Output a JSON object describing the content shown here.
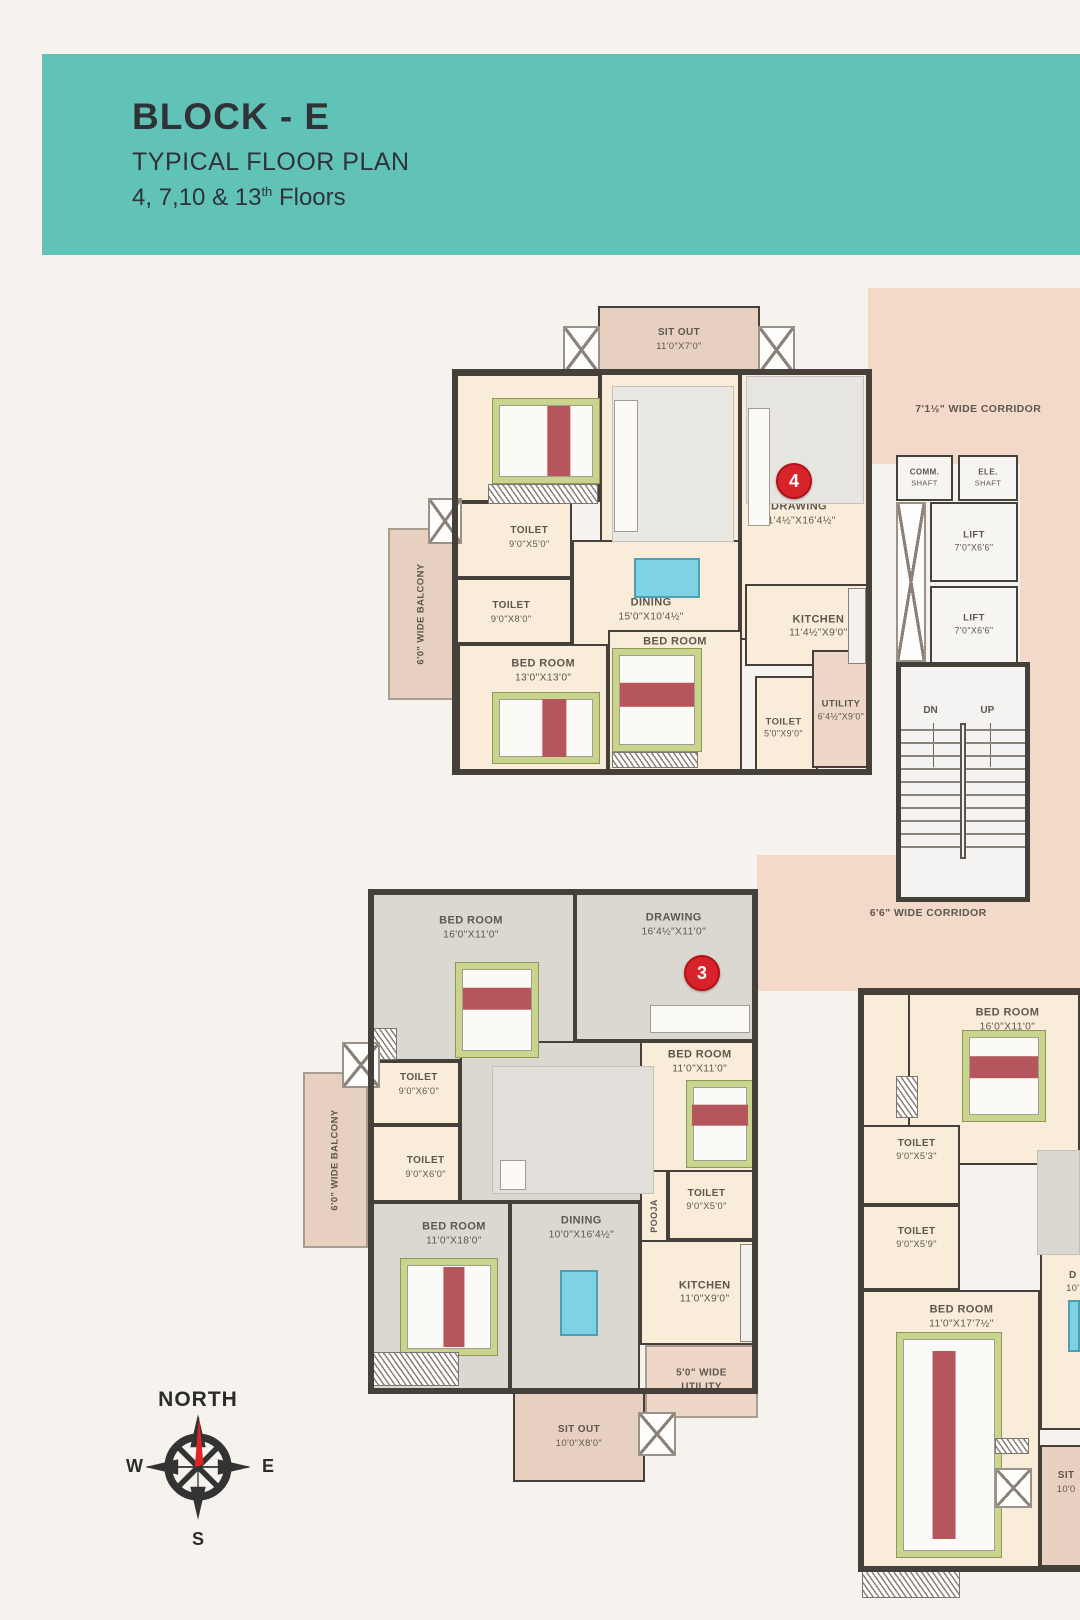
{
  "header": {
    "title": "BLOCK - E",
    "subtitle": "TYPICAL FLOOR PLAN",
    "floors": "4, 7,10 & 13",
    "floors_sup": "th",
    "floors_tail": " Floors",
    "band_color": "#61c2b8",
    "text_color": "#2f3338"
  },
  "compass": {
    "north": "NORTH",
    "west": "W",
    "east": "E",
    "south": "S"
  },
  "plan": {
    "wall_color": "#46403a",
    "room_fill": "#f9ecd9",
    "gray_fill": "#dbd7d1",
    "tan_fill": "#e8d0c0",
    "pink_fill": "#f3d9c8",
    "utility_fill": "#eed7c7",
    "white_fill": "#f6f5f2",
    "marker_color": "#d8232a",
    "stairs": {
      "dn": "DN",
      "up": "UP"
    },
    "markers": [
      {
        "num": "4",
        "x": 792,
        "y": 479
      },
      {
        "num": "3",
        "x": 700,
        "y": 971
      }
    ],
    "units": [
      {
        "name": "unit-4-outline",
        "x": 452,
        "y": 369,
        "w": 420,
        "h": 406
      },
      {
        "name": "unit-3-outline",
        "x": 368,
        "y": 889,
        "w": 390,
        "h": 505
      },
      {
        "name": "unit-right-outline",
        "x": 858,
        "y": 988,
        "w": 232,
        "h": 584
      }
    ],
    "zones": [
      {
        "name": "corridor-top",
        "label": "7'1½\" WIDE CORRIDOR",
        "x": 868,
        "y": 288,
        "w": 212,
        "h": 176,
        "fill": "#f3d9c8",
        "lx": 52,
        "ly": 69,
        "fs": 10.5
      },
      {
        "name": "corridor-right",
        "x": 1020,
        "y": 462,
        "w": 60,
        "h": 396,
        "fill": "#f3d9c8"
      },
      {
        "name": "corridor-mid",
        "label": "6'6\" WIDE CORRIDOR",
        "x": 757,
        "y": 855,
        "w": 323,
        "h": 136,
        "fill": "#f3d9c8",
        "lx": 53,
        "ly": 43,
        "fs": 10.5
      },
      {
        "name": "balcony-unit4",
        "label": "6'0\" WIDE BALCONY",
        "x": 388,
        "y": 528,
        "w": 67,
        "h": 172,
        "fill": "#e8d0c0",
        "vertical": true,
        "bordered": true,
        "fs": 9.5
      },
      {
        "name": "balcony-unit3",
        "label": "6'0\" WIDE BALCONY",
        "x": 303,
        "y": 1072,
        "w": 65,
        "h": 176,
        "fill": "#e8d0c0",
        "vertical": true,
        "bordered": true,
        "fs": 9.5
      },
      {
        "name": "utility-unit3",
        "label": "5'0\" WIDE UTILITY",
        "x": 645,
        "y": 1345,
        "w": 113,
        "h": 73,
        "fill": "#eed7c7",
        "bordered": true,
        "wrap": true,
        "lx": 50,
        "ly": 48,
        "fs": 10
      }
    ],
    "rooms": [
      {
        "name": "sitout-unit4",
        "line1": "SIT OUT",
        "line2": "11'0\"X7'0\"",
        "x": 598,
        "y": 306,
        "w": 162,
        "h": 66,
        "fill": "#e8d0c0",
        "fs": 10
      },
      {
        "name": "bedroom-1-unit4",
        "line1": "BED ROOM",
        "line2": "13'0\"X11'0\"",
        "x": 455,
        "y": 374,
        "w": 145,
        "h": 128,
        "lx": 60,
        "ly": 42
      },
      {
        "name": "living-unit4",
        "line1": "LIVING",
        "line2": "11'0\"X10'4½\"",
        "x": 600,
        "y": 372,
        "w": 140,
        "h": 180,
        "lx": 70,
        "ly": 42
      },
      {
        "name": "drawing-unit4",
        "line1": "DRAWING",
        "line2": "11'4½\"X16'4½\"",
        "x": 740,
        "y": 372,
        "w": 128,
        "h": 268,
        "lx": 46,
        "ly": 53
      },
      {
        "name": "toilet-1-unit4",
        "line1": "TOILET",
        "line2": "9'0\"X5'0\"",
        "x": 455,
        "y": 502,
        "w": 117,
        "h": 76,
        "lx": 64,
        "ly": 46,
        "fs": 10
      },
      {
        "name": "toilet-2-unit4",
        "line1": "TOILET",
        "line2": "9'0\"X8'0\"",
        "x": 455,
        "y": 578,
        "w": 117,
        "h": 66,
        "lx": 48,
        "ly": 52,
        "fs": 10
      },
      {
        "name": "dining-unit4",
        "line1": "DINING",
        "line2": "15'0\"X10'4½\"",
        "x": 572,
        "y": 540,
        "w": 168,
        "h": 110,
        "lx": 47,
        "ly": 64
      },
      {
        "name": "kitchen-unit4",
        "line1": "KITCHEN",
        "line2": "11'4½\"X9'0\"",
        "x": 745,
        "y": 584,
        "w": 123,
        "h": 82,
        "lx": 60,
        "ly": 52
      },
      {
        "name": "bedroom-2-unit4",
        "line1": "BED ROOM",
        "line2": "13'0\"X13'0\"",
        "x": 458,
        "y": 644,
        "w": 150,
        "h": 128,
        "lx": 57,
        "ly": 20
      },
      {
        "name": "bedroom-3-unit4",
        "line1": "BED ROOM",
        "line2": "11'0\"X13'0\"",
        "x": 608,
        "y": 630,
        "w": 134,
        "h": 142,
        "lx": 50,
        "ly": 12
      },
      {
        "name": "toilet-3-unit4",
        "line1": "TOILET",
        "line2": "5'0\"X9'0\"",
        "x": 755,
        "y": 676,
        "w": 63,
        "h": 96,
        "lx": 45,
        "ly": 55,
        "fs": 9.5
      },
      {
        "name": "utility-unit4",
        "line1": "UTILITY",
        "line2": "6'4½\"X9'0\"",
        "x": 812,
        "y": 650,
        "w": 58,
        "h": 118,
        "fill": "#eed7c7",
        "lx": 50,
        "ly": 52,
        "fs": 9.5
      },
      {
        "name": "comm-shaft",
        "line1": "COMM.",
        "line2": "SHAFT",
        "x": 896,
        "y": 455,
        "w": 57,
        "h": 46,
        "fill": "#f6f5f2",
        "fs": 8
      },
      {
        "name": "ele-shaft",
        "line1": "ELE.",
        "line2": "SHAFT",
        "x": 958,
        "y": 455,
        "w": 60,
        "h": 46,
        "fill": "#f6f5f2",
        "fs": 8
      },
      {
        "name": "lift-1",
        "line1": "LIFT",
        "line2": "7'0\"X6'6\"",
        "x": 930,
        "y": 502,
        "w": 88,
        "h": 80,
        "fill": "#f6f5f2",
        "fs": 9.5
      },
      {
        "name": "lift-2",
        "line1": "LIFT",
        "line2": "7'0\"X6'6\"",
        "x": 930,
        "y": 586,
        "w": 88,
        "h": 78,
        "fill": "#f6f5f2",
        "fs": 9.5
      },
      {
        "name": "bedroom-1-unit3",
        "line1": "BED ROOM",
        "line2": "16'0\"X11'0\"",
        "x": 371,
        "y": 893,
        "w": 204,
        "h": 168,
        "fill": "#dbd7d1",
        "lx": 49,
        "ly": 20
      },
      {
        "name": "drawing-unit3",
        "line1": "DRAWING",
        "line2": "16'4½\"X11'0\"",
        "x": 575,
        "y": 893,
        "w": 180,
        "h": 148,
        "fill": "#dbd7d1",
        "lx": 55,
        "ly": 21
      },
      {
        "name": "toilet-1-unit3",
        "line1": "TOILET",
        "line2": "9'0\"X6'0\"",
        "x": 371,
        "y": 1061,
        "w": 89,
        "h": 64,
        "lx": 54,
        "ly": 35,
        "fs": 10
      },
      {
        "name": "toilet-2-unit3",
        "line1": "TOILET",
        "line2": "9'0\"X6'0\"",
        "x": 371,
        "y": 1125,
        "w": 89,
        "h": 77,
        "lx": 62,
        "ly": 55,
        "fs": 10
      },
      {
        "name": "living-unit3",
        "line1": "LIVING",
        "line2": "12'0\"X12'0\"",
        "x": 460,
        "y": 1041,
        "w": 200,
        "h": 161,
        "fill": "#dbd7d1",
        "lx": 73,
        "ly": 55
      },
      {
        "name": "bedroom-2-unit3",
        "line1": "BED ROOM",
        "line2": "11'0\"X11'0\"",
        "x": 640,
        "y": 1041,
        "w": 115,
        "h": 131,
        "lx": 52,
        "ly": 15
      },
      {
        "name": "toilet-3-unit3",
        "line1": "TOILET",
        "line2": "9'0\"X5'0\"",
        "x": 668,
        "y": 1170,
        "w": 87,
        "h": 70,
        "lx": 44,
        "ly": 42,
        "fs": 10
      },
      {
        "name": "pooja-unit3",
        "line1": "POOJA",
        "x": 640,
        "y": 1170,
        "w": 28,
        "h": 92,
        "vertical": true,
        "fs": 9
      },
      {
        "name": "dining-unit3",
        "line1": "DINING",
        "line2": "10'0\"X16'4½\"",
        "x": 510,
        "y": 1202,
        "w": 130,
        "h": 190,
        "fill": "#dbd7d1",
        "lx": 55,
        "ly": 13
      },
      {
        "name": "bedroom-3-unit3",
        "line1": "BED ROOM",
        "line2": "11'0\"X18'0\"",
        "x": 371,
        "y": 1202,
        "w": 139,
        "h": 190,
        "fill": "#dbd7d1",
        "lx": 60,
        "ly": 16
      },
      {
        "name": "kitchen-unit3",
        "line1": "KITCHEN",
        "line2": "11'0\"X9'0\"",
        "x": 640,
        "y": 1240,
        "w": 118,
        "h": 105,
        "lx": 55,
        "ly": 50
      },
      {
        "name": "sitout-unit3",
        "line1": "SIT OUT",
        "line2": "10'0\"X8'0\"",
        "x": 513,
        "y": 1390,
        "w": 132,
        "h": 92,
        "fill": "#e8d0c0",
        "fs": 10
      },
      {
        "name": "entry-strip-right",
        "x": 860,
        "y": 993,
        "w": 50,
        "h": 134
      },
      {
        "name": "bedroom-1-right",
        "line1": "BED ROOM",
        "line2": "16'0\"X11'0\"",
        "x": 908,
        "y": 993,
        "w": 172,
        "h": 172,
        "lx": 58,
        "ly": 15
      },
      {
        "name": "toilet-1-right",
        "line1": "TOILET",
        "line2": "9'0\"X5'3\"",
        "x": 862,
        "y": 1125,
        "w": 98,
        "h": 80,
        "lx": 56,
        "ly": 30,
        "fs": 10
      },
      {
        "name": "toilet-2-right",
        "line1": "TOILET",
        "line2": "9'0\"X5'9\"",
        "x": 862,
        "y": 1205,
        "w": 98,
        "h": 85,
        "lx": 56,
        "ly": 38,
        "fs": 10
      },
      {
        "name": "bedroom-2-right",
        "line1": "BED ROOM",
        "line2": "11'0\"X17'7½\"",
        "x": 862,
        "y": 1290,
        "w": 178,
        "h": 282,
        "lx": 56,
        "ly": 9
      },
      {
        "name": "dining-partial-right",
        "line1": "D",
        "line2": "10'",
        "x": 1040,
        "y": 1250,
        "w": 48,
        "h": 180,
        "lx": 70,
        "ly": 17,
        "fs": 10
      },
      {
        "name": "sitout-partial-right",
        "line1": "SIT",
        "line2": "10'0",
        "x": 1040,
        "y": 1445,
        "w": 48,
        "h": 122,
        "fill": "#e8d0c0",
        "lx": 55,
        "ly": 30,
        "fs": 10
      }
    ],
    "furniture": [
      {
        "t": "zone",
        "name": "drawing-sofa-area-unit4",
        "x": 746,
        "y": 376,
        "w": 118,
        "h": 128,
        "fill": "#e7e5e0"
      },
      {
        "t": "zone",
        "name": "living-rug-unit4",
        "x": 612,
        "y": 386,
        "w": 122,
        "h": 156,
        "fill": "#eae8e3"
      },
      {
        "t": "zone",
        "name": "living-rug-unit3",
        "x": 492,
        "y": 1066,
        "w": 162,
        "h": 128,
        "fill": "#e2dfda"
      },
      {
        "t": "zone",
        "name": "living-partial-right",
        "x": 1037,
        "y": 1150,
        "w": 43,
        "h": 105,
        "fill": "#dbd7d1"
      },
      {
        "t": "sofa",
        "name": "sofa-living-unit4",
        "x": 614,
        "y": 400,
        "w": 24,
        "h": 132
      },
      {
        "t": "sofa",
        "name": "sofa-drawing-unit4",
        "x": 748,
        "y": 408,
        "w": 22,
        "h": 118
      },
      {
        "t": "sofa",
        "name": "sofa-drawing-unit3",
        "x": 650,
        "y": 1005,
        "w": 100,
        "h": 28
      },
      {
        "t": "sofa",
        "name": "sofa-living-unit3",
        "x": 500,
        "y": 1160,
        "w": 26,
        "h": 30
      },
      {
        "t": "bed",
        "name": "bed-bedroom1-unit4",
        "x": 492,
        "y": 398,
        "w": 108,
        "h": 86,
        "dir": "v",
        "sp": 62
      },
      {
        "t": "bed",
        "name": "bed-bedroom3-unit4",
        "x": 612,
        "y": 648,
        "w": 90,
        "h": 104,
        "dir": "h",
        "sp": 45
      },
      {
        "t": "bed",
        "name": "bed-bedroom2-unit4",
        "x": 492,
        "y": 692,
        "w": 108,
        "h": 72,
        "dir": "v",
        "sp": 58
      },
      {
        "t": "bed",
        "name": "bed-bedroom1-unit3",
        "x": 455,
        "y": 962,
        "w": 84,
        "h": 96,
        "dir": "h",
        "sp": 38
      },
      {
        "t": "bed",
        "name": "bed-bedroom2-unit3",
        "x": 686,
        "y": 1080,
        "w": 68,
        "h": 88,
        "dir": "h",
        "sp": 40
      },
      {
        "t": "bed",
        "name": "bed-bedroom3-unit3",
        "x": 400,
        "y": 1258,
        "w": 98,
        "h": 98,
        "dir": "v",
        "sp": 55
      },
      {
        "t": "bed",
        "name": "bed-bedroom1-right",
        "x": 962,
        "y": 1030,
        "w": 84,
        "h": 92,
        "dir": "h",
        "sp": 40
      },
      {
        "t": "bed",
        "name": "bed-bedroom2-right",
        "x": 896,
        "y": 1332,
        "w": 106,
        "h": 226,
        "dir": "v",
        "sp": 45
      },
      {
        "t": "table",
        "name": "dining-table-unit4",
        "x": 634,
        "y": 558,
        "w": 66,
        "h": 40
      },
      {
        "t": "table",
        "name": "dining-table-unit3",
        "x": 560,
        "y": 1270,
        "w": 38,
        "h": 66
      },
      {
        "t": "table",
        "name": "dining-table-partial-right",
        "x": 1068,
        "y": 1300,
        "w": 12,
        "h": 52
      },
      {
        "t": "counter",
        "name": "kitchen-counter-unit4",
        "x": 848,
        "y": 588,
        "w": 18,
        "h": 76
      },
      {
        "t": "counter",
        "name": "kitchen-counter-unit3",
        "x": 740,
        "y": 1244,
        "w": 16,
        "h": 98
      }
    ],
    "hatches": [
      {
        "x": 488,
        "y": 484,
        "w": 110,
        "h": 20
      },
      {
        "x": 612,
        "y": 752,
        "w": 86,
        "h": 16
      },
      {
        "x": 373,
        "y": 1028,
        "w": 24,
        "h": 32
      },
      {
        "x": 373,
        "y": 1352,
        "w": 86,
        "h": 34
      },
      {
        "x": 862,
        "y": 1566,
        "w": 98,
        "h": 32
      },
      {
        "x": 995,
        "y": 1438,
        "w": 34,
        "h": 16
      },
      {
        "x": 896,
        "y": 1076,
        "w": 22,
        "h": 42
      }
    ],
    "xboxes": [
      {
        "x": 563,
        "y": 326,
        "w": 37,
        "h": 48
      },
      {
        "x": 758,
        "y": 326,
        "w": 37,
        "h": 48
      },
      {
        "x": 428,
        "y": 498,
        "w": 34,
        "h": 46
      },
      {
        "x": 342,
        "y": 1042,
        "w": 38,
        "h": 46
      },
      {
        "x": 638,
        "y": 1412,
        "w": 38,
        "h": 44
      },
      {
        "x": 995,
        "y": 1468,
        "w": 37,
        "h": 40
      },
      {
        "x": 896,
        "y": 502,
        "w": 30,
        "h": 160
      }
    ]
  }
}
